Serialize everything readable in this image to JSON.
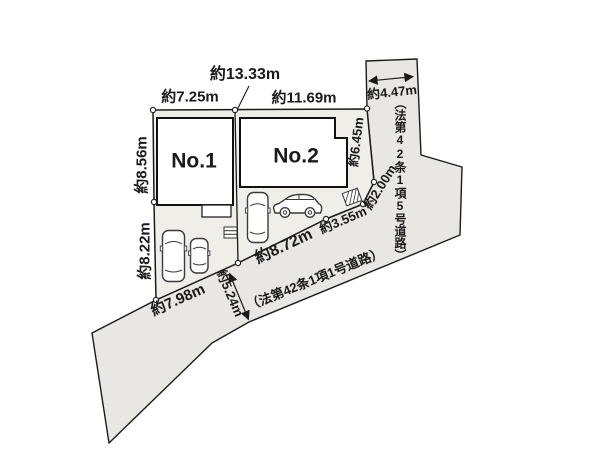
{
  "plots": {
    "no1": {
      "label": "No.1"
    },
    "no2": {
      "label": "No.2"
    }
  },
  "dimensions": {
    "d1333": "約13.33m",
    "d725": "約7.25m",
    "d1169": "約11.69m",
    "d856": "約8.56m",
    "d822": "約8.22m",
    "d798": "約7.98m",
    "d872": "約8.72m",
    "d355": "約3.55m",
    "d200": "約2.00m",
    "d645": "約6.45m",
    "d447": "約4.47m",
    "d524": "約5.24m"
  },
  "roads": {
    "main_label": "（法第42条1項1号道路）",
    "right_label": "（法第42条1項5号道路）"
  },
  "icons": {
    "car_top": "car-top-view-icon",
    "car_side": "car-side-view-icon",
    "stairs": "stairs-icon",
    "utility_box": "hatched-box-icon"
  },
  "colors": {
    "parcel_fill": "#efeee9",
    "road_fill": "#e8e7e3",
    "line": "#1b1b1b",
    "building_fill": "#ffffff",
    "text": "#1a1a1a"
  }
}
